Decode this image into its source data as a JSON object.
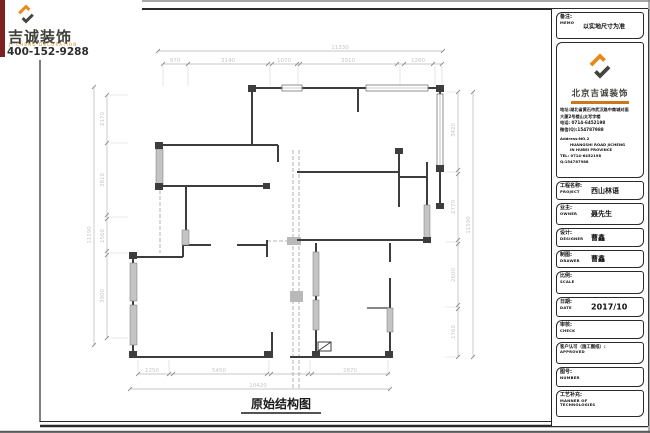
{
  "logo": {
    "company": "吉诚装饰",
    "tagline": "JI CHENG DECORATION",
    "phone": "400-152-9288"
  },
  "drawing": {
    "title": "原始结构图",
    "dims": {
      "top_total": "11330",
      "top_segments": [
        "970",
        "3140",
        "1070",
        "3910",
        "1260"
      ],
      "left_total": "11190",
      "left_segments": [
        "2170",
        "3810",
        "1560",
        "3900"
      ],
      "right_total": "11590",
      "right_segments": [
        "3420",
        "2770",
        "2600",
        "1760"
      ],
      "bottom_total": "10420",
      "bottom_segments": [
        "1250",
        "5450",
        "2870"
      ]
    }
  },
  "titleblock": {
    "memo_label": "备注:",
    "memo_sub": "MEMO",
    "memo_value": "以实地尺寸为准",
    "company_name": "北京吉诚装饰",
    "address_cn": [
      "地址:湖北省黄石市武汉路中商城对面",
      "大厦2号楼山太写字楼",
      "电话: 0714-6452198",
      "微信(Q):154787988"
    ],
    "address_en": [
      "Address:NO.2",
      "HUANGSHI ROAD JICHENG",
      "IN HUBEI PROVINCE",
      "TEL: 0714-6452198",
      "Q:154787988"
    ],
    "rows": [
      {
        "label": "工程名称:",
        "sub": "PROJECT",
        "value": "西山林语"
      },
      {
        "label": "业主:",
        "sub": "OWNER",
        "value": "聂先生"
      },
      {
        "label": "设计:",
        "sub": "DESIGNER",
        "value": "曹鑫"
      },
      {
        "label": "制图:",
        "sub": "DRAWER",
        "value": "曹鑫"
      },
      {
        "label": "比例:",
        "sub": "SCALE",
        "value": ""
      },
      {
        "label": "日期:",
        "sub": "DATE",
        "value": "2017/10"
      },
      {
        "label": "审核:",
        "sub": "CHECK",
        "value": ""
      },
      {
        "label": "客户认可（施工图纸）:",
        "sub": "APPROVED",
        "value": ""
      },
      {
        "label": "图号:",
        "sub": "NUMBER",
        "value": ""
      },
      {
        "label": "工艺补充:",
        "sub": "MANNER OF",
        "sub2": "TECHNOLOGIES",
        "value": ""
      }
    ]
  },
  "colors": {
    "accent_orange": "#e8891c",
    "logo_dark": "#45453e",
    "wall": "#3d3d3d",
    "dimension_gray": "#c6c6c6",
    "red_strip": "#7d2121"
  }
}
